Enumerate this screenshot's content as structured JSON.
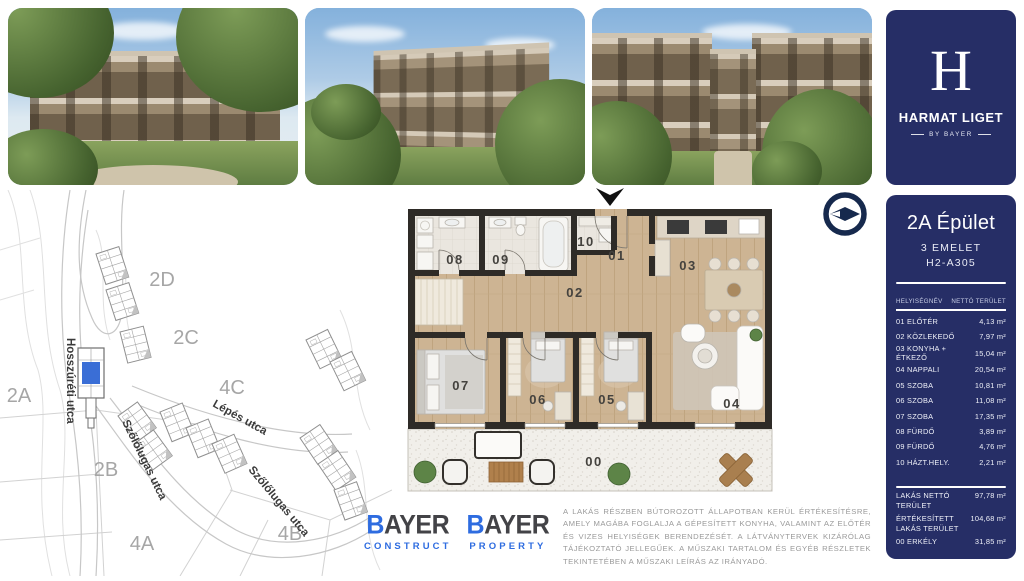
{
  "brand": {
    "logo_letter": "H",
    "name": "HARMAT LIGET",
    "byline": "BY BAYER"
  },
  "unit": {
    "building": "2A Épület",
    "floor": "3 EMELET",
    "code": "H2-A305"
  },
  "table": {
    "col_room": "HELYISÉGNÉV",
    "col_area": "NETTÓ TERÜLET",
    "rows": [
      {
        "name": "01 ELŐTÉR",
        "area": "4,13 m²"
      },
      {
        "name": "02 KÖZLEKEDŐ",
        "area": "7,97 m²"
      },
      {
        "name": "03 KONYHA + ÉTKEZŐ",
        "area": "15,04 m²"
      },
      {
        "name": "04 NAPPALI",
        "area": "20,54 m²"
      },
      {
        "name": "05 SZOBA",
        "area": "10,81 m²"
      },
      {
        "name": "06 SZOBA",
        "area": "11,08 m²"
      },
      {
        "name": "07 SZOBA",
        "area": "17,35 m²"
      },
      {
        "name": "08 FÜRDŐ",
        "area": "3,89 m²"
      },
      {
        "name": "09 FÜRDŐ",
        "area": "4,76 m²"
      },
      {
        "name": "10 HÁZT.HELY.",
        "area": "2,21 m²"
      }
    ],
    "summary": [
      {
        "name": "LAKÁS NETTÓ TERÜLET",
        "area": "97,78 m²"
      },
      {
        "name": "ÉRTÉKESÍTETT LAKÁS TERÜLET",
        "area": "104,68 m²"
      },
      {
        "name": "00 ERKÉLY",
        "area": "31,85 m²"
      }
    ]
  },
  "map": {
    "blocks": [
      "2D",
      "2C",
      "4C",
      "2A",
      "2B",
      "4A",
      "4B"
    ],
    "streets": [
      "Hosszúréti utca",
      "Lépés utca",
      "Szőlőlugas utca",
      "Szőlőlugas utca"
    ]
  },
  "floorplan": {
    "rooms": [
      "01",
      "02",
      "03",
      "04",
      "05",
      "06",
      "07",
      "08",
      "09",
      "10",
      "00"
    ]
  },
  "logos": {
    "construct": {
      "b": "B",
      "rest": "AYER",
      "sub": "CONSTRUCT"
    },
    "property": {
      "b": "B",
      "rest": "AYER",
      "sub": "PROPERTY"
    }
  },
  "disclaimer": "A LAKÁS RÉSZBEN BÚTOROZOTT ÁLLAPOTBAN KERÜL ÉRTÉKESÍTÉSRE, AMELY MAGÁBA FOGLALJA A GÉPESÍTETT KONYHA, VALAMINT AZ ELŐTÉR ÉS VIZES HELYISÉGEK BERENDEZÉSÉT. A LÁTVÁNYTERVEK KIZÁRÓLAG TÁJÉKOZTATÓ JELLEGŰEK. A MŰSZAKI TARTALOM ÉS EGYÉB RÉSZLETEK TEKINTETÉBEN A MŰSZAKI LEÍRÁS AZ IRÁNYADÓ.",
  "colors": {
    "navy": "#262e66",
    "bayer_blue": "#2e6ce0",
    "highlight_unit": "#3a6ed6"
  }
}
